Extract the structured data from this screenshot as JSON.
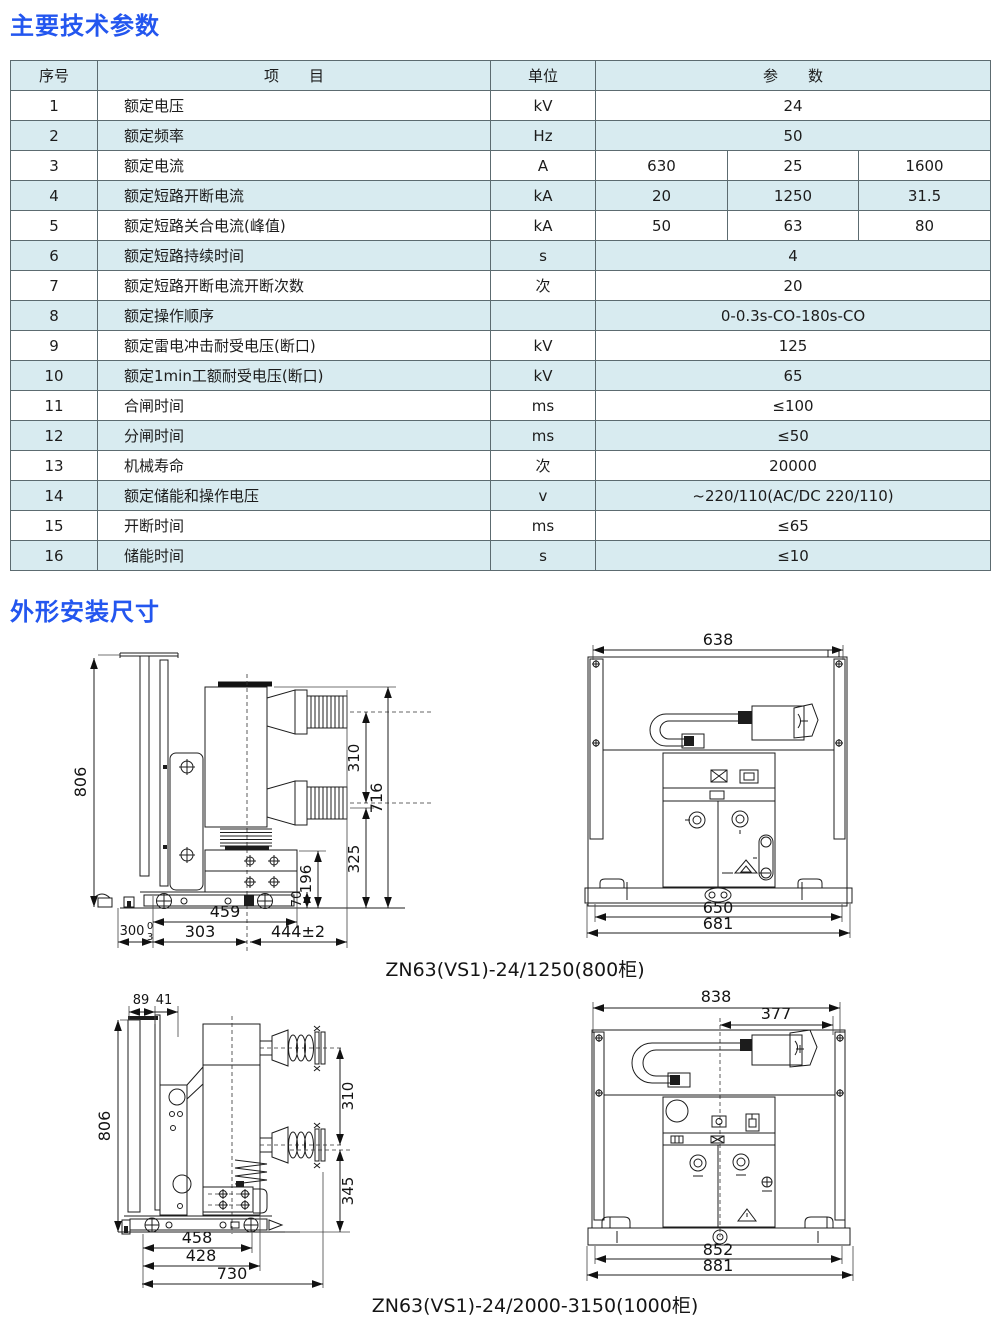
{
  "page": {
    "section1_title": "主要技术参数",
    "section2_title": "外形安装尺寸"
  },
  "colors": {
    "accent_blue": "#2356ef",
    "table_alt_row": "#d8ebf0",
    "line_color": "#1c1c1c"
  },
  "table": {
    "headers": {
      "no": "序号",
      "item": "项　　目",
      "unit": "单位",
      "param": "参　　数"
    },
    "rows": [
      {
        "no": "1",
        "item": "额定电压",
        "unit": "kV",
        "values": [
          "24"
        ]
      },
      {
        "no": "2",
        "item": "额定频率",
        "unit": "Hz",
        "values": [
          "50"
        ]
      },
      {
        "no": "3",
        "item": "额定电流",
        "unit": "A",
        "values": [
          "630",
          "25",
          "1600"
        ]
      },
      {
        "no": "4",
        "item": "额定短路开断电流",
        "unit": "kA",
        "values": [
          "20",
          "1250",
          "31.5"
        ]
      },
      {
        "no": "5",
        "item": "额定短路关合电流(峰值)",
        "unit": "kA",
        "values": [
          "50",
          "63",
          "80"
        ]
      },
      {
        "no": "6",
        "item": "额定短路持续时间",
        "unit": "s",
        "values": [
          "4"
        ]
      },
      {
        "no": "7",
        "item": "额定短路开断电流开断次数",
        "unit": "次",
        "values": [
          "20"
        ]
      },
      {
        "no": "8",
        "item": "额定操作顺序",
        "unit": "",
        "values": [
          "0-0.3s-CO-180s-CO"
        ]
      },
      {
        "no": "9",
        "item": "额定雷电冲击耐受电压(断口)",
        "unit": "kV",
        "values": [
          "125"
        ]
      },
      {
        "no": "10",
        "item": "额定1min工额耐受电压(断口)",
        "unit": "kV",
        "values": [
          "65"
        ]
      },
      {
        "no": "11",
        "item": "合闸时间",
        "unit": "ms",
        "values": [
          "≤100"
        ]
      },
      {
        "no": "12",
        "item": "分闸时间",
        "unit": "ms",
        "values": [
          "≤50"
        ]
      },
      {
        "no": "13",
        "item": "机械寿命",
        "unit": "次",
        "values": [
          "20000"
        ]
      },
      {
        "no": "14",
        "item": "额定储能和操作电压",
        "unit": "v",
        "values": [
          "~220/110(AC/DC 220/110)"
        ]
      },
      {
        "no": "15",
        "item": "开断时间",
        "unit": "ms",
        "values": [
          "≤65"
        ]
      },
      {
        "no": "16",
        "item": "储能时间",
        "unit": "s",
        "values": [
          "≤10"
        ]
      }
    ]
  },
  "drawing1": {
    "caption": "ZN63(VS1)-24/1250(800柜)",
    "dims": {
      "height_overall": "806",
      "pole_spacing": "310",
      "height_right": "716",
      "lower_span": "325",
      "box_height": "196",
      "base_height": "70",
      "tol_main": "300",
      "tol_upper": "0",
      "tol_lower": "3",
      "width_459": "459",
      "width_303": "303",
      "width_444": "444±2"
    }
  },
  "drawing2": {
    "dims": {
      "width_top": "638",
      "width_650": "650",
      "width_681": "681"
    }
  },
  "drawing3": {
    "dims": {
      "top_89": "89",
      "top_41": "41",
      "height_overall": "806",
      "pole_spacing": "310",
      "lower_span": "345",
      "width_458": "458",
      "width_428": "428",
      "width_730": "730"
    }
  },
  "drawing4": {
    "caption": "ZN63(VS1)-24/2000-3150(1000柜)",
    "dims": {
      "width_top": "838",
      "width_377": "377",
      "width_852": "852",
      "width_881": "881"
    }
  }
}
